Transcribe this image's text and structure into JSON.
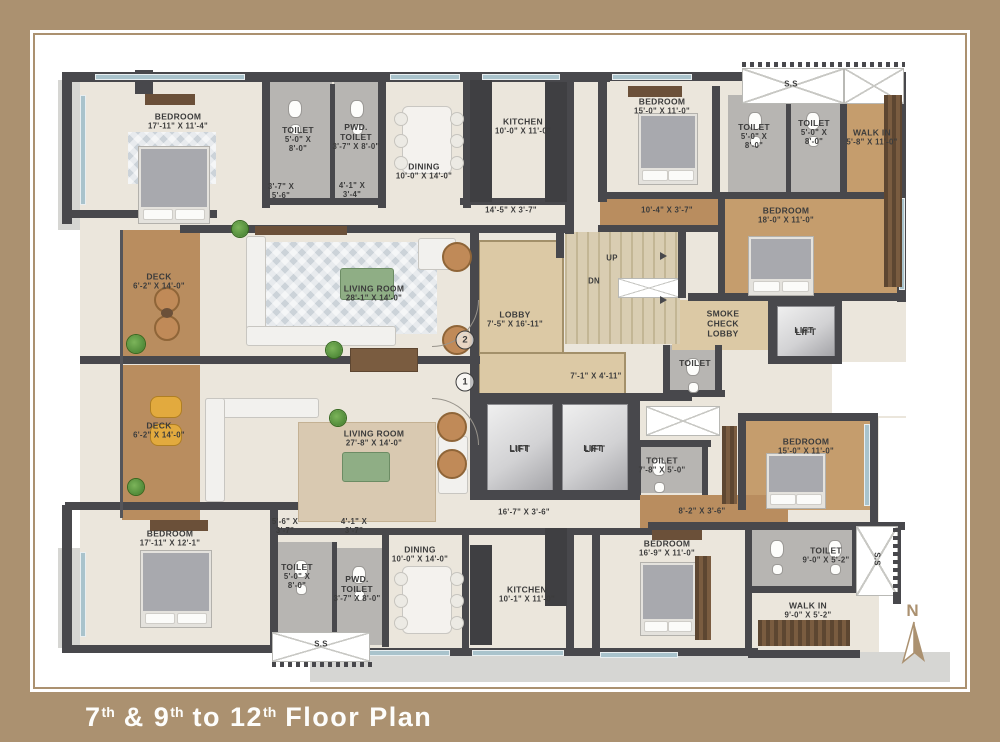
{
  "title": {
    "parts": [
      {
        "text": "7",
        "sup": false
      },
      {
        "text": "th",
        "sup": true
      },
      {
        "text": " & 9",
        "sup": false
      },
      {
        "text": "th",
        "sup": true
      },
      {
        "text": " to 12",
        "sup": false
      },
      {
        "text": "th",
        "sup": true
      },
      {
        "text": " Floor Plan",
        "sup": false
      }
    ]
  },
  "colors": {
    "frame_tan": "#ab9170",
    "wall_dark": "#48484c",
    "floor_cream": "#ebe6dc",
    "floor_wood": "#b98d5f",
    "floor_wood_light": "#c59d6d",
    "toilet_gray": "#b7b5b2",
    "lobby_beige": "#dcc9a5",
    "slab_gray": "#d6d6d3",
    "window_blue": "#a9c3cc",
    "text_dark": "#3c3c3c"
  },
  "rooms": {
    "bedroom_tl": {
      "name": "BEDROOM",
      "dims": "17'-11\" X 11'-4\""
    },
    "toilet_tl": {
      "name": "TOILET",
      "dims": "5'-0\" X 8'-0\""
    },
    "pwd_toilet_tl": {
      "name": "PWD. TOILET",
      "dims": "3'-7\" X 8'-0\""
    },
    "dining_top": {
      "name": "DINING",
      "dims": "10'-0\" X 14'-0\""
    },
    "kitchen_top": {
      "name": "KITCHEN",
      "dims": "10'-0\" X 11'-0\""
    },
    "bedroom_tm": {
      "name": "BEDROOM",
      "dims": "15'-0\" X 11'-0\""
    },
    "toilet_tr1": {
      "name": "TOILET",
      "dims": "5'-0\" X 8'-0\""
    },
    "toilet_tr2": {
      "name": "TOILET",
      "dims": "5'-0\" X 8'-0\""
    },
    "walkin_tr": {
      "name": "WALK IN",
      "dims": "5'-8\" X 11'-0\""
    },
    "bedroom_r18": {
      "name": "BEDROOM",
      "dims": "18'-0\" X 11'-0\""
    },
    "deck_1": {
      "name": "DECK",
      "dims": "6'-2\" X 14'-0\""
    },
    "living_1": {
      "name": "LIVING ROOM",
      "dims": "28'-1\" X 14'-0\""
    },
    "lobby": {
      "name": "LOBBY",
      "dims": "7'-5\" X 16'-11\""
    },
    "smoke_lobby": {
      "name": "SMOKE CHECK LOBBY",
      "dims": ""
    },
    "toilet_mid": {
      "name": "TOILET",
      "dims": ""
    },
    "lift_r": {
      "name": "LIFT",
      "dims": ""
    },
    "deck_2": {
      "name": "DECK",
      "dims": "6'-2\" X 14'-0\""
    },
    "living_2": {
      "name": "LIVING ROOM",
      "dims": "27'-8\" X 14'-0\""
    },
    "lift_1": {
      "name": "LIFT",
      "dims": ""
    },
    "lift_2": {
      "name": "LIFT",
      "dims": ""
    },
    "toilet_c": {
      "name": "TOILET",
      "dims": "7'-8\" X 5'-0\""
    },
    "bedroom_r15": {
      "name": "BEDROOM",
      "dims": "15'-0\" X 11'-0\""
    },
    "bedroom_bl": {
      "name": "BEDROOM",
      "dims": "17'-11\" X 12'-1\""
    },
    "toilet_bl": {
      "name": "TOILET",
      "dims": "5'-0\" X 8'-0\""
    },
    "pwd_toilet_bl": {
      "name": "PWD. TOILET",
      "dims": "3'-7\" X 8'-0\""
    },
    "dining_bot": {
      "name": "DINING",
      "dims": "10'-0\" X 14'-0\""
    },
    "kitchen_bot": {
      "name": "KITCHEN",
      "dims": "10'-1\" X 11'-0\""
    },
    "bedroom_bm": {
      "name": "BEDROOM",
      "dims": "16'-9\" X 11'-0\""
    },
    "toilet_br": {
      "name": "TOILET",
      "dims": "9'-0\" X 5'-2\""
    },
    "walkin_br": {
      "name": "WALK IN",
      "dims": "9'-0\" X 5'-2\""
    }
  },
  "annotations": {
    "pass_tl_a": "3'-7\" X 5'-6\"",
    "pass_tl_b": "4'-1\" X 3'-4\"",
    "corr_top_left": "14'-5\" X 3'-7\"",
    "corr_top_right": "10'-4\" X 3'-7\"",
    "corr_mid": "7'-1\" X 4'-11\"",
    "corr_bot_left": "16'-7\" X 3'-6\"",
    "corr_bot_right": "8'-2\" X 3'-6\"",
    "pass_bl_a": "5'-6\" X 3'-7\"",
    "pass_bl_b": "4'-1\" X 3'-7\"",
    "ss_top": "S.S",
    "ss_bottom": "S.S",
    "ss_right": "S.S",
    "up": "UP",
    "dn": "DN",
    "unit_1": "1",
    "unit_2": "2",
    "compass_n": "N"
  }
}
